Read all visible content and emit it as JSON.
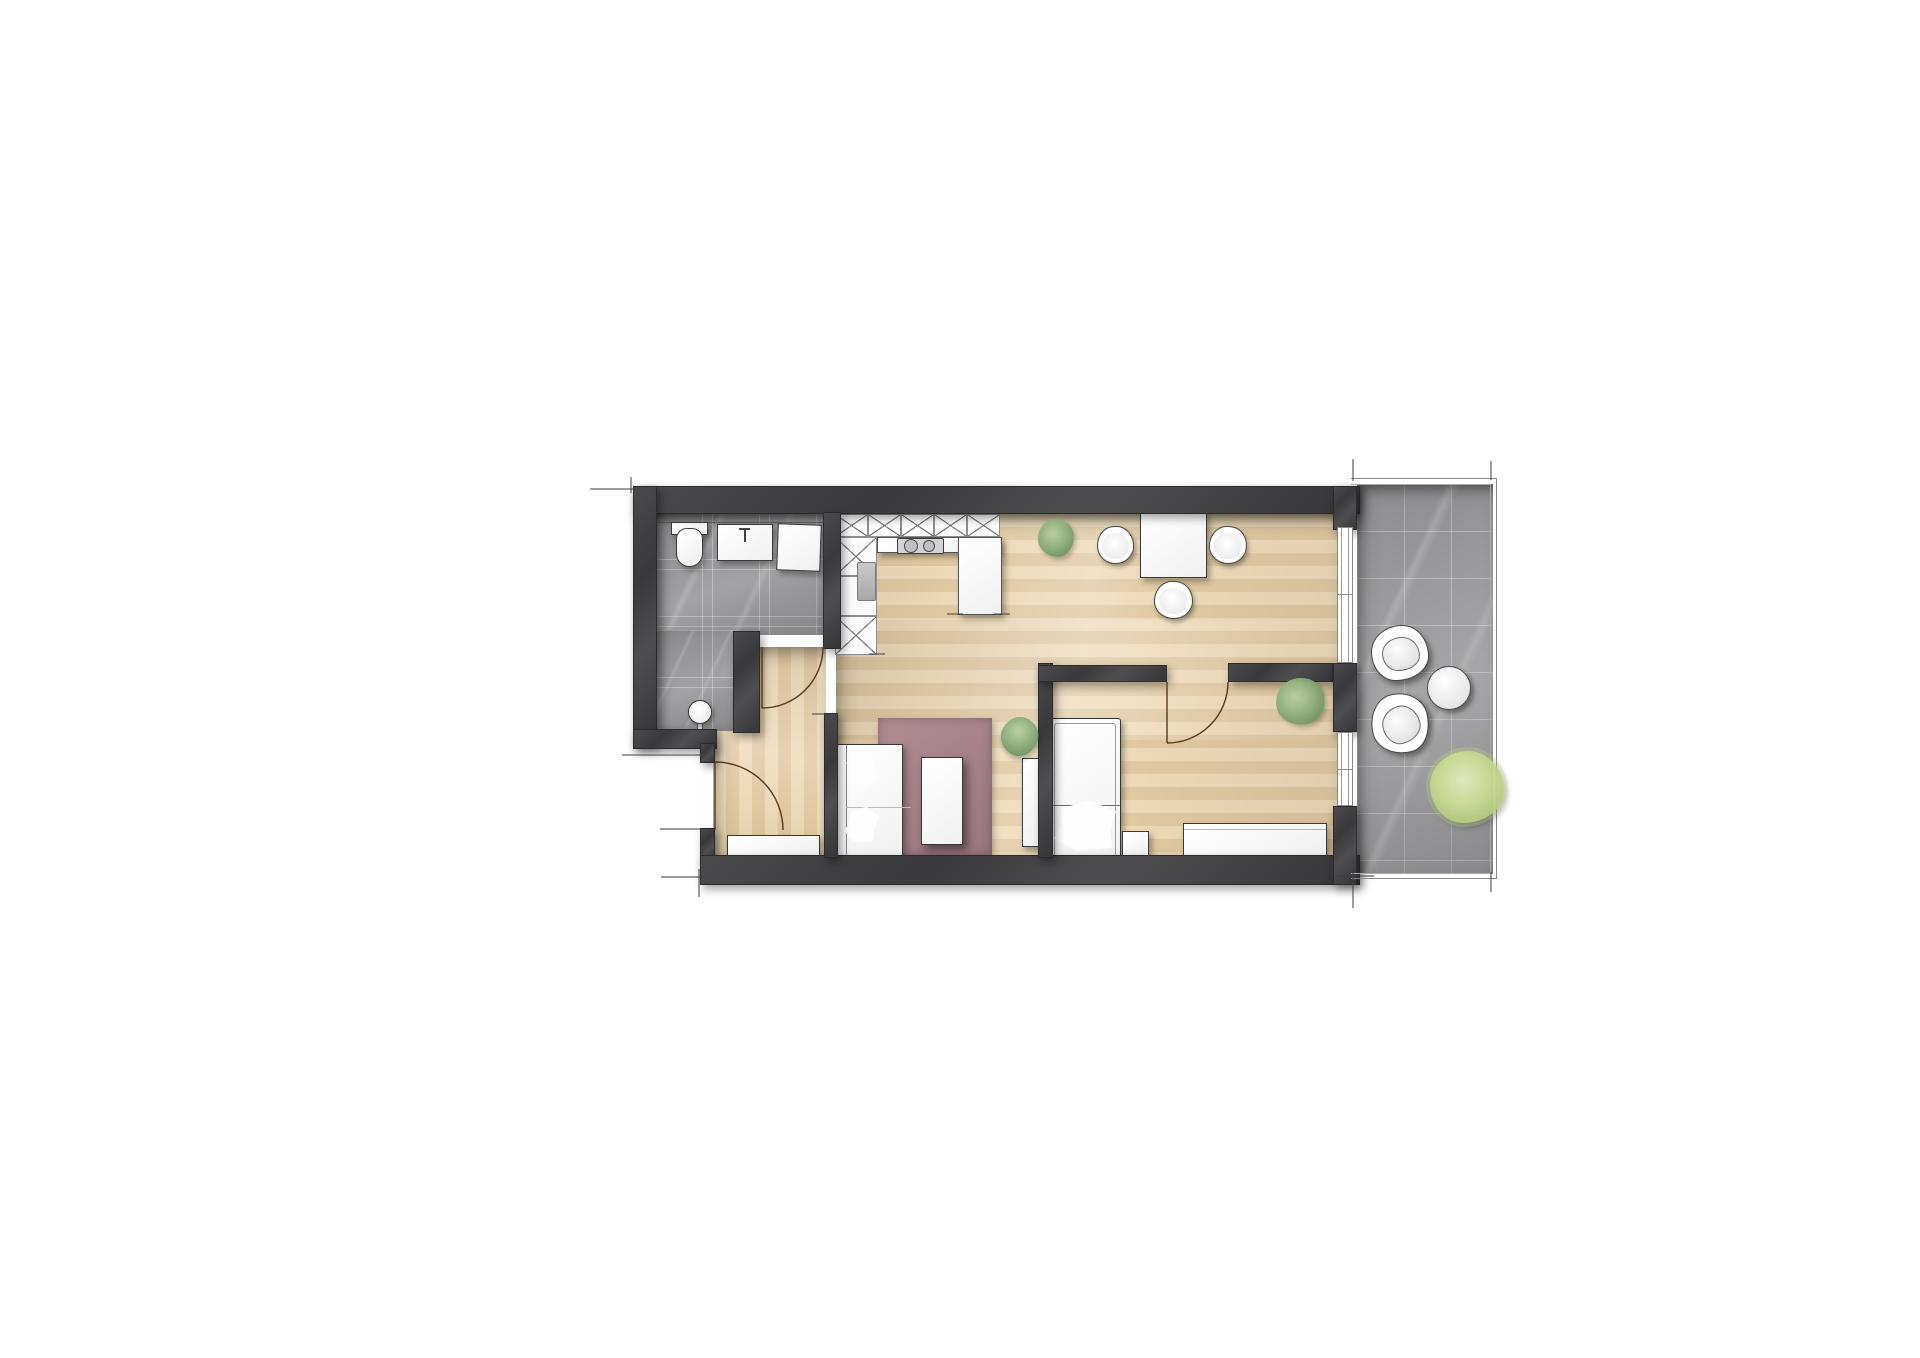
{
  "document_type": "apartment-floor-plan",
  "palette": {
    "wall": "#3f3e40",
    "wood_floor": "#e6d2ab",
    "bathroom_tile": "#98989a",
    "balcony_tile": "#9c9b9d",
    "rug": "#a8868d",
    "furniture": "#ffffff",
    "plant_green": "#8fae7c",
    "balcony_plant_green": "#ccdd96",
    "door_swing_arc": "#57391c",
    "dimension_tick": "#3e3e40"
  },
  "rooms": [
    {
      "name": "bathroom",
      "floor": "stone-tile",
      "fixtures": [
        "toilet",
        "vanity-sink",
        "shower-unit",
        "shower-fixture"
      ]
    },
    {
      "name": "entry-hall",
      "floor": "wood-plank-vertical",
      "fixtures": [
        "entry-door",
        "sideboard"
      ]
    },
    {
      "name": "kitchen",
      "floor": "wood-plank",
      "fixtures": [
        "tall-cabinet-row",
        "tall-cabinet-column",
        "built-in-appliance",
        "counter-with-cooktop",
        "counter-peninsula"
      ]
    },
    {
      "name": "dining-area",
      "floor": "wood-plank",
      "fixtures": [
        "dining-table",
        "chair-left",
        "chair-right",
        "chair-bottom",
        "potted-plant"
      ]
    },
    {
      "name": "living-area",
      "floor": "wood-plank",
      "fixtures": [
        "sofa",
        "sofa-pillows",
        "area-rug",
        "coffee-table",
        "tv-lowboard",
        "potted-plant"
      ]
    },
    {
      "name": "bedroom",
      "floor": "wood-plank",
      "fixtures": [
        "single-bed",
        "bed-pillow",
        "nightstand",
        "wardrobe-sideboard",
        "potted-plant",
        "bedroom-door",
        "window-to-balcony"
      ]
    },
    {
      "name": "balcony",
      "floor": "stone-tile",
      "fixtures": [
        "lounge-chair-1",
        "lounge-chair-2",
        "round-side-table",
        "large-shrub",
        "railing",
        "sliding-glass-door"
      ]
    }
  ],
  "doors": [
    "entry-door-swing",
    "bathroom-door-swing",
    "bedroom-door-swing"
  ],
  "annotations": [
    "dimension-ticks-top-left",
    "dimension-ticks-bottom-left",
    "dimension-ticks-balcony"
  ]
}
